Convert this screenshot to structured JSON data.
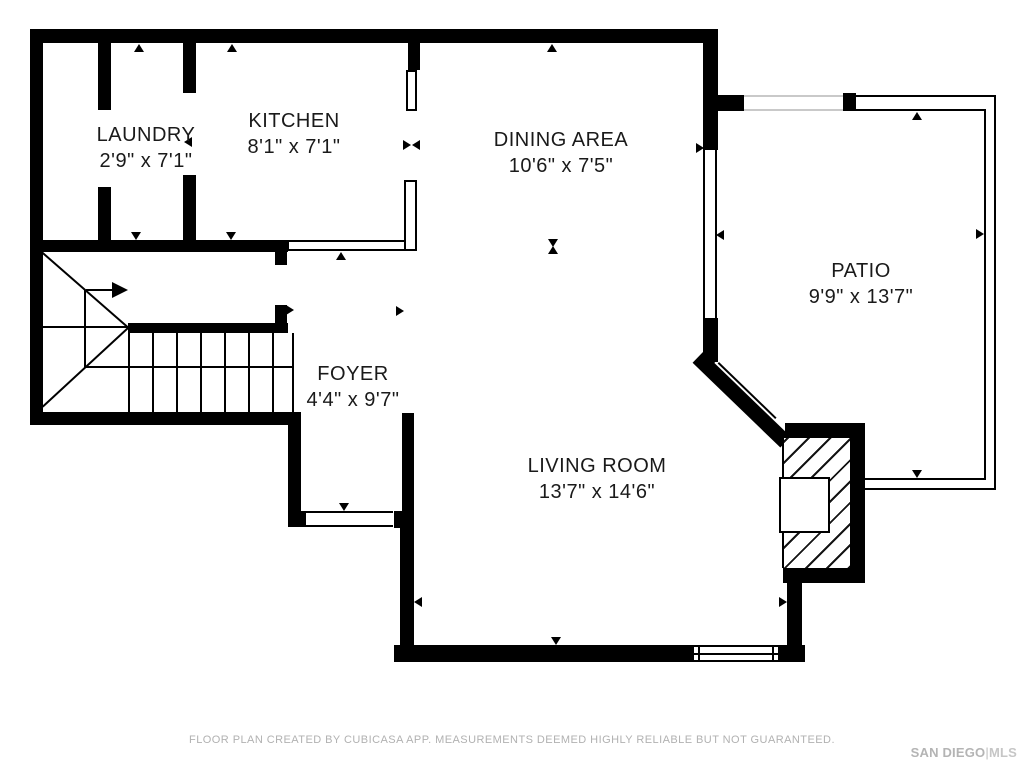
{
  "rooms": [
    {
      "name": "LAUNDRY",
      "dims": "2'9\" x 7'1\""
    },
    {
      "name": "KITCHEN",
      "dims": "8'1\" x 7'1\""
    },
    {
      "name": "DINING AREA",
      "dims": "10'6\" x 7'5\""
    },
    {
      "name": "PATIO",
      "dims": "9'9\" x 13'7\""
    },
    {
      "name": "FOYER",
      "dims": "4'4\" x 9'7\""
    },
    {
      "name": "LIVING ROOM",
      "dims": "13'7\" x 14'6\""
    }
  ],
  "footer": {
    "disclaimer": "FLOOR PLAN CREATED BY CUBICASA APP. MEASUREMENTS DEEMED HIGHLY RELIABLE BUT NOT GUARANTEED."
  },
  "branding": {
    "name": "SAN DIEGO",
    "separator": "|",
    "suffix": "MLS"
  },
  "colors": {
    "wall": "#000000",
    "label_text": "#1a1a1a",
    "footer_text": "#b1b1b1",
    "brand_text": "#b4b4b4"
  }
}
